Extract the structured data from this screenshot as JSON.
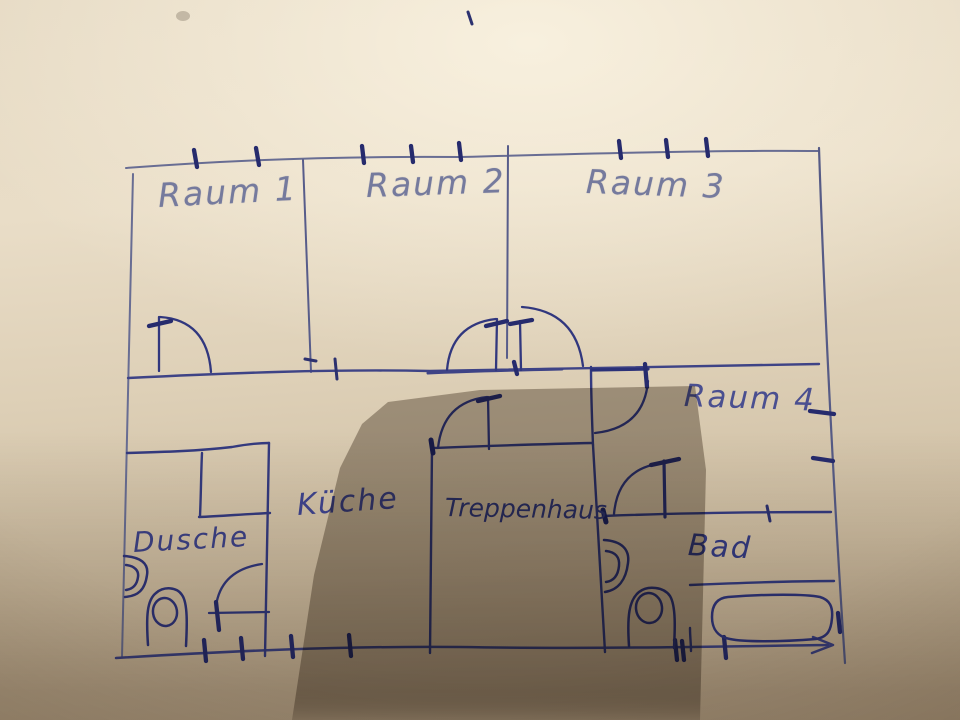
{
  "photo": {
    "medium": "hand-drawn floor plan, blue ballpoint pen on beige paper",
    "ink_color": "#343a80",
    "faded_ink_color": "#757a9d",
    "paper_color": "#ddd0b8"
  },
  "rooms": {
    "raum1": {
      "label": "Raum 1"
    },
    "raum2": {
      "label": "Raum 2"
    },
    "raum3": {
      "label": "Raum 3"
    },
    "raum4": {
      "label": "Raum 4"
    },
    "kueche": {
      "label": "Küche"
    },
    "treppenhaus": {
      "label": "Treppenhaus"
    },
    "dusche": {
      "label": "Dusche"
    },
    "bad": {
      "label": "Bad"
    }
  },
  "fixtures": {
    "dusche": [
      "wash-basin",
      "toilet",
      "shower-cabinet"
    ],
    "bad": [
      "wash-basin",
      "toilet",
      "bathtub"
    ]
  },
  "annotations": {
    "window_ticks_top": 8,
    "window_ticks_bottom": 7,
    "window_ticks_right_wall": 3,
    "arrow": "bottom-right end of outline"
  }
}
